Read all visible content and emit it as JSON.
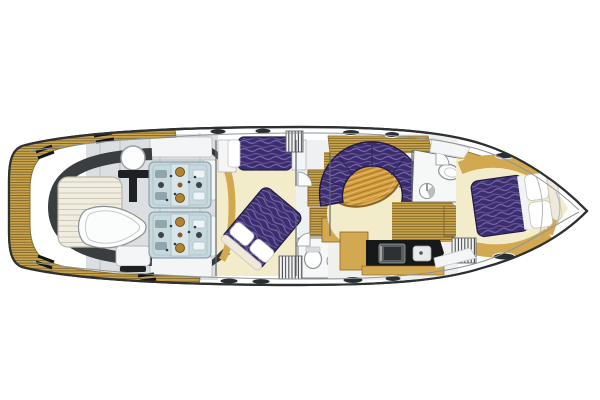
{
  "page": {
    "background": "#ffffff"
  },
  "colors": {
    "hull_outline": "#2e3134",
    "hull_fill": "#ffffff",
    "inner_line": "#8e959b",
    "teak": "#c9a44c",
    "teak_stripe": "#6f5a24",
    "teak_edge": "#8a6f2e",
    "gold": "#d2a851",
    "gold_dark": "#8a6327",
    "cream": "#f3ecca",
    "purple": "#3c2e6e",
    "purple_wave": "#7466a8",
    "purple_outline": "#221c45",
    "wood": "#d49c3f",
    "wood_dark": "#a8771f",
    "wood_light": "#e9c577",
    "deck_gray": "#dcdfe2",
    "deck_seam": "#b2b6ba",
    "panel_white": "#f4f5f6",
    "panel_stroke": "#b5b9bd",
    "dark_band": "#3b3e41",
    "dark_wedge": "#33363a",
    "black": "#17181a",
    "engine_body": "#c8d9dd",
    "engine_stroke": "#7d98a0",
    "engine_gold": "#b08434",
    "sunpad": "#f0ecdf",
    "sunpad_line": "#c9c5b6",
    "lobby_white": "#eef0f1",
    "salon_base": "#f0f1ee",
    "floor_white": "#f6f7f7",
    "hatch_oval": "#2b2e31",
    "wall": "#62676c",
    "fixture_stroke": "#8b9094",
    "fixture_gray": "#b9bdc1",
    "counter_appliance": "#595e62"
  },
  "features": {
    "engines": 2,
    "berths": 3,
    "heads": 2,
    "settees": 1,
    "tables": 1,
    "tenders": 1
  }
}
